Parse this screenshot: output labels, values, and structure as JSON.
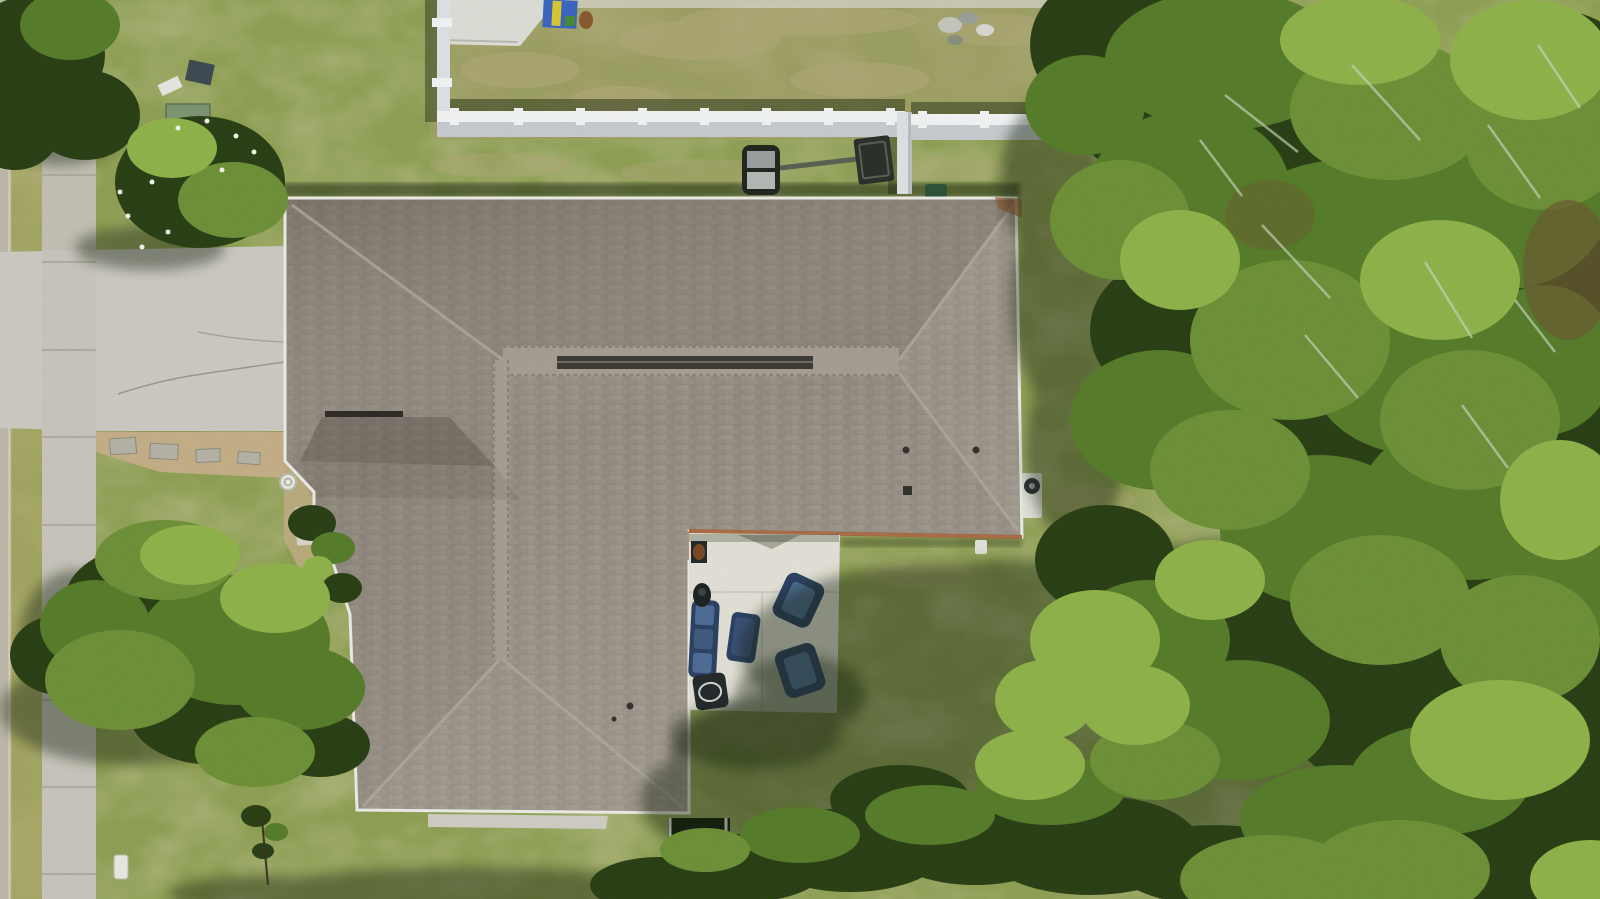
{
  "scene": {
    "type": "aerial-drone-photograph",
    "description": "Top-down aerial view of a single-family home with a gray-taupe shingle hip roof. A sidewalk and road edge run along the left, a concrete driveway crosses to the house, a white vinyl privacy fence separates the rear neighbor's patchy yard (with a tipped basketball hoop and a child's playset) from the lawn. Behind the house is a concrete patio with navy outdoor furniture and an AC unit; large oak canopies with Spanish moss cover the right side and cast shadows on the back lawn.",
    "objects": [
      {
        "label": "house-hip-roof"
      },
      {
        "label": "ridge-vent"
      },
      {
        "label": "front-gable"
      },
      {
        "label": "driveway"
      },
      {
        "label": "sidewalk"
      },
      {
        "label": "road-edge"
      },
      {
        "label": "gravel-planting-bed"
      },
      {
        "label": "front-walk"
      },
      {
        "label": "well-cover"
      },
      {
        "label": "privacy-fence"
      },
      {
        "label": "basketball-hoop"
      },
      {
        "label": "kids-playset"
      },
      {
        "label": "utility-boxes"
      },
      {
        "label": "trash-can"
      },
      {
        "label": "debris-pile"
      },
      {
        "label": "patio"
      },
      {
        "label": "outdoor-sofa"
      },
      {
        "label": "armchair"
      },
      {
        "label": "armchair"
      },
      {
        "label": "ottoman"
      },
      {
        "label": "grill"
      },
      {
        "label": "side-table"
      },
      {
        "label": "low-table"
      },
      {
        "label": "ac-unit"
      },
      {
        "label": "fire-pit"
      },
      {
        "label": "screened-enclosure"
      },
      {
        "label": "rear-walkway"
      },
      {
        "label": "flowering-shrub"
      },
      {
        "label": "front-oak-tree"
      },
      {
        "label": "right-oak-canopy"
      },
      {
        "label": "spanish-moss"
      },
      {
        "label": "sapling"
      },
      {
        "label": "utility-marker"
      },
      {
        "label": "tree-shadows"
      }
    ]
  },
  "palette": {
    "grass_base": "#8fa055",
    "grass_dry": "#b0a76b",
    "neighbor_grass": "#a89f70",
    "tan_patch": "#b3a97c",
    "shadow": "#16240c",
    "road": "#bdb8aa",
    "curb": "#ded8c2",
    "sidewalk": "#c7c5bc",
    "driveway": "#cbc9c2",
    "gravel": "#c3ae87",
    "paver": "#b5b2a7",
    "roof_base": "#968e85",
    "roof_light": "#a79e94",
    "ridge_vent": "#3c3a35",
    "gutter_white": "#ebebe6",
    "drip_rust": "#a0582e",
    "fence_white": "#dde1e4",
    "fence_face": "#c6cbd0",
    "fence_post": "#f1f3f4",
    "patio_concrete": "#e2e0d6",
    "furniture_navy": "#2c4163",
    "furniture_cushion": "#4d6b95",
    "table_dark": "#24292c",
    "grill_black": "#1e2224",
    "tree_dark": "#2a3f16",
    "tree_mid": "#567c2b",
    "tree_mid2": "#6d9038",
    "tree_bright": "#8fb24a",
    "moss": "#ccd6bf",
    "brown_patch": "#6b5a33",
    "pad_white": "#dcded7",
    "playset_blue": "#3a66c0",
    "playset_yellow": "#d9c737",
    "dog_brown": "#8a5a30",
    "utility_green": "#7e9472",
    "utility_slate": "#3e4a52",
    "hoop_dark": "#22261f",
    "backboard": "#2c302b",
    "pole": "#5a6052",
    "trash_green": "#2c5238",
    "enclosure_dark": "#151d10",
    "firepit_pad": "#c2a172",
    "walkway": "#cfcdc4",
    "ac_white": "#e0e1db",
    "well_white": "#e9e9e3",
    "marker_white": "#e8e8e2",
    "debris_gray": "#c4c6bd",
    "flower_white": "#f2f2ea"
  }
}
